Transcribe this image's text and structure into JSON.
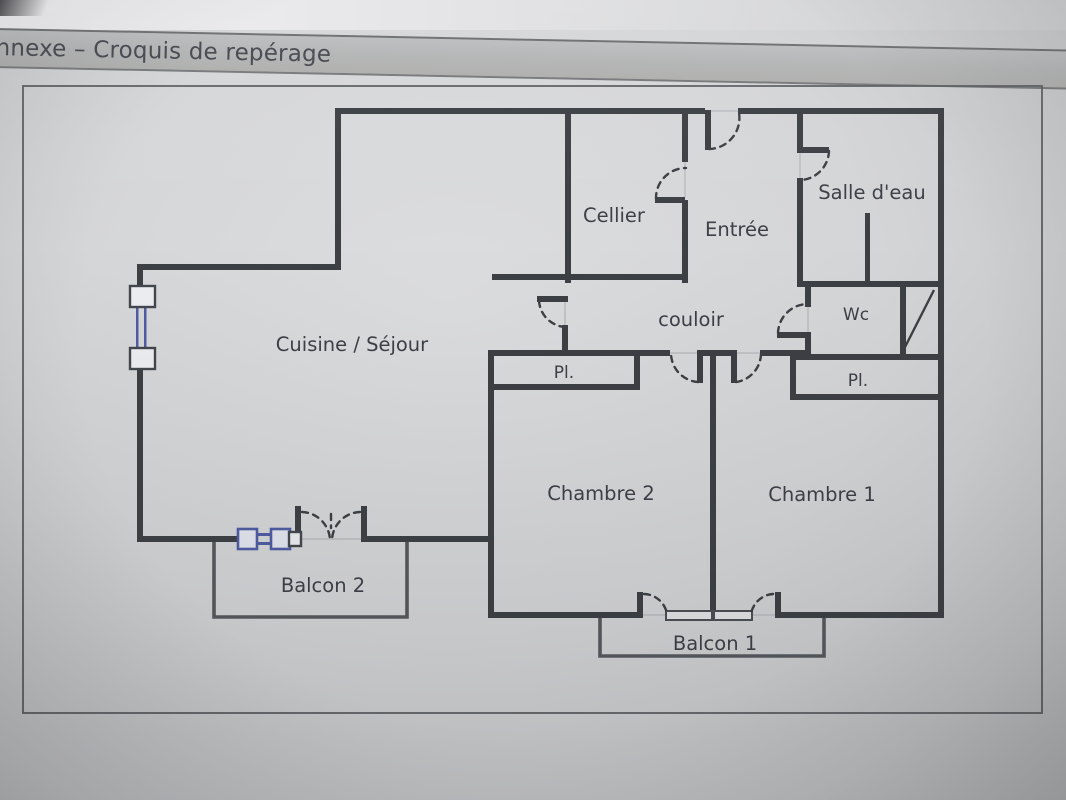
{
  "header": {
    "title": "nnexe – Croquis de repérage"
  },
  "floorplan": {
    "labels": {
      "cuisine_sejour": "Cuisine / Séjour",
      "cellier": "Cellier",
      "entree": "Entrée",
      "salle_deau": "Salle d'eau",
      "couloir": "couloir",
      "wc": "Wc",
      "pl_chambre2": "Pl.",
      "pl_chambre1": "Pl.",
      "chambre2": "Chambre 2",
      "chambre1": "Chambre 1",
      "balcon2": "Balcon 2",
      "balcon1": "Balcon 1"
    }
  },
  "colors": {
    "wall": "#3c3f44",
    "window_blue": "#4f5ca4",
    "paper": "#d8d9db",
    "header_bar": "#b2b3b3"
  }
}
